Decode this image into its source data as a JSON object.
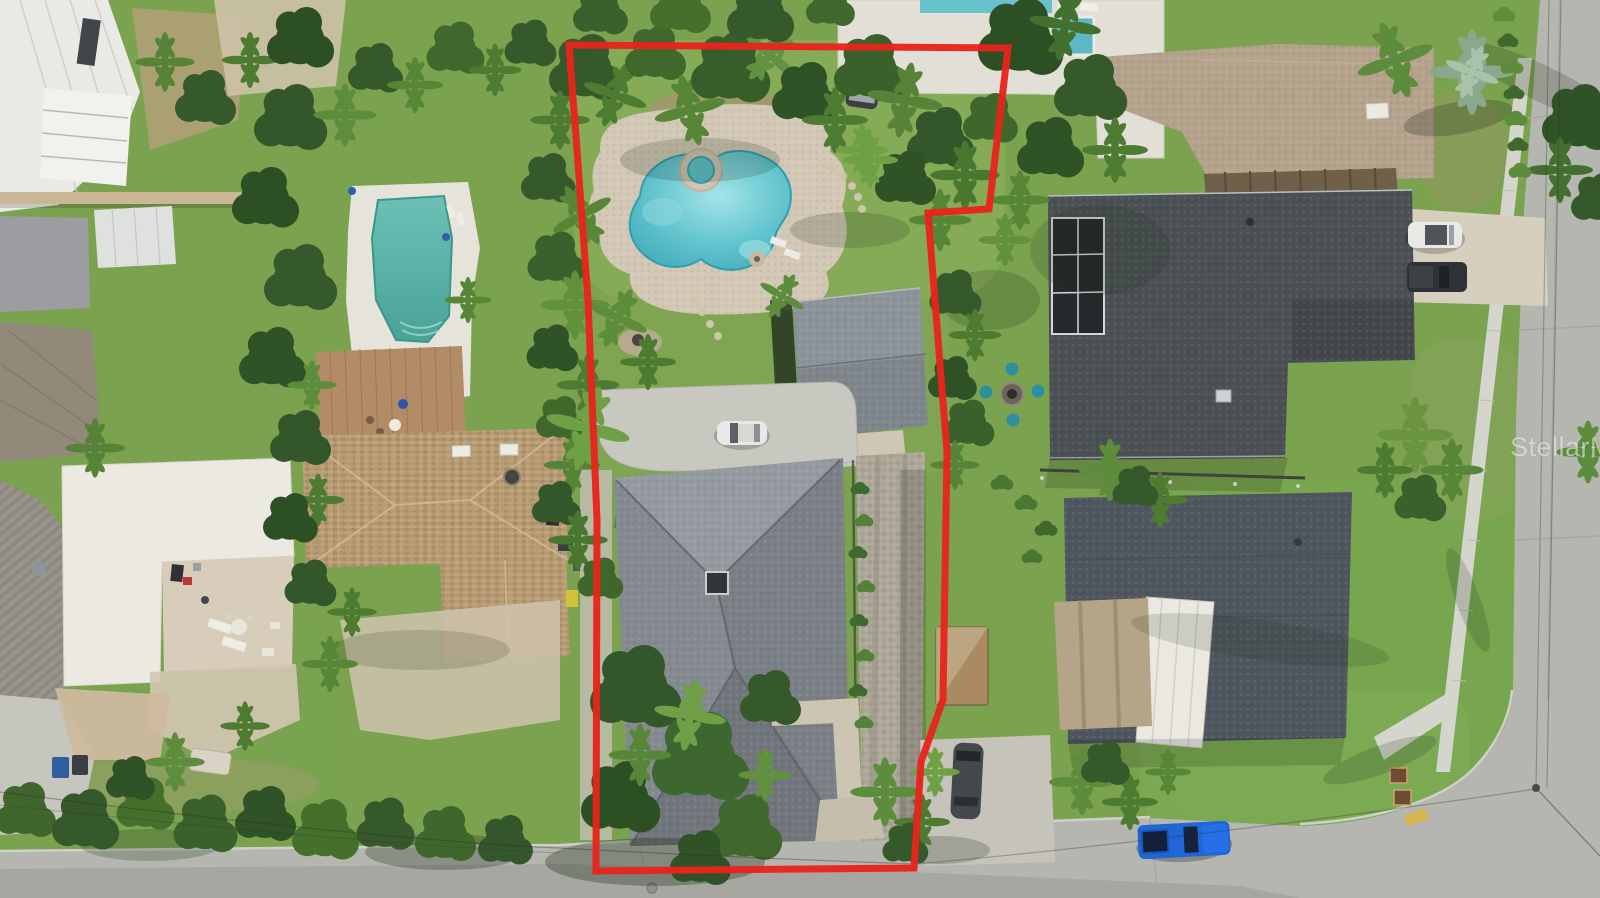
{
  "scene": {
    "type": "aerial-drone-photo",
    "description": "Overhead aerial photo of a coastal Florida neighborhood. A red boundary outline highlights a deep residential lot containing a free-form pool with round spa on a stone paver deck, a detached garage, a circular front drive with a white car, and a large gray hip-roof home shaded by mature palms and oaks. Neighboring homes with pools, driveways, parked cars, a sidewalk and two intersecting concrete streets surround the outlined property.",
    "watermark": {
      "text": "StellarMLS",
      "color": "rgba(255,255,255,0.52)"
    },
    "property_boundary": {
      "color": "#e8241c",
      "stroke_width": 7,
      "points": "569,45 1008,48 989,209 928,213 947,452 943,700 921,762 914,868 596,871 597,520 588,300 577,150"
    },
    "palette": {
      "lawn": "#7aa24f",
      "street": "#b5b6b0",
      "sidewalk": "#d4d5cc",
      "pool_water": "#5fc0ca",
      "left_pool_water": "#57b1a6",
      "subject_roof": "#848a8f",
      "neighbor_roof_dark": "#4b5054",
      "neighbor_roof_brown": "#b69a74",
      "paver_deck": "#d2c8b5",
      "boundary_red": "#e8241c"
    },
    "objects": {
      "pools": [
        "free-form pool with round spa inside outlined lot",
        "rectangular green-teal pool at left neighbor",
        "lap pool with square spa on white deck at top-right neighbor"
      ],
      "vehicles": [
        "white car on outlined lot front drive",
        "dark vehicle under trees at rear of outlined lot",
        "white SUV in right neighbor driveway",
        "dark truck in right neighbor driveway",
        "dark gray car on driveway below right neighbor",
        "bright blue pickup parked on bottom street"
      ],
      "structures": [
        "gray hip-roof main house",
        "detached garage on outlined lot",
        "brown shake-roof house at left",
        "white flat-roof house at lower left",
        "white metal-roof building at upper left",
        "charcoal-roof house with screened lanai at right",
        "blue-gray-roof house with white awning at lower right",
        "tan-roof house at top right",
        "wood shed between lots"
      ]
    }
  }
}
